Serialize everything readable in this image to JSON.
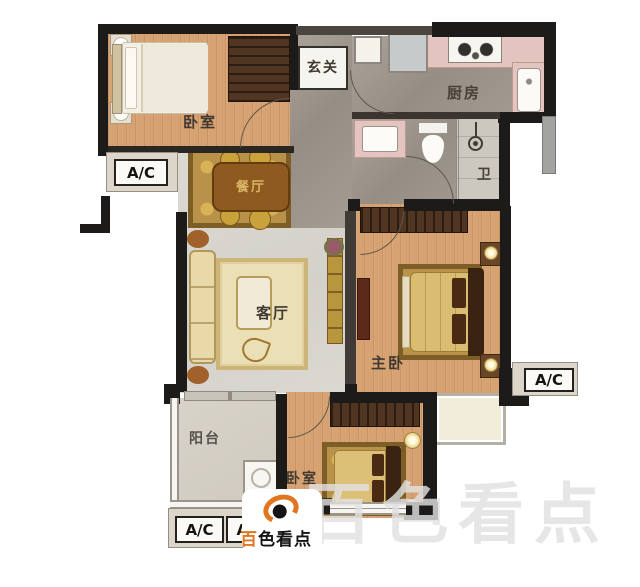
{
  "rooms": {
    "bedroom_top": {
      "label": "卧室"
    },
    "entry": {
      "label": "玄关"
    },
    "kitchen": {
      "label": "厨房"
    },
    "bath": {
      "label": "卫"
    },
    "dining": {
      "label": "餐厅"
    },
    "living": {
      "label": "客厅"
    },
    "master": {
      "label": "主卧"
    },
    "balcony": {
      "label": "阳台"
    },
    "bedroom_bottom": {
      "label": "卧室"
    }
  },
  "ac_units": {
    "left": "A/C",
    "right": "A/C",
    "bottom_1": "A/C",
    "bottom_2": "A/C"
  },
  "watermark": {
    "large_text": "百色看点",
    "badge_accent": "百",
    "badge_rest": "色看点"
  },
  "colors": {
    "wall": "#1d1b19",
    "wood_floor": "#d7a271",
    "marble_floor": "#a49c92",
    "living_floor": "#d9d6d0",
    "counter_pink": "#e4c4be",
    "rug_gold": "#b9924a",
    "rug_cream": "#ebdfb6",
    "wardrobe_brown": "#503523",
    "badge_accent_orange": "#e0761f",
    "watermark_gray": "#e4e4e4",
    "ac_box_bg": "#fbfaf6"
  }
}
